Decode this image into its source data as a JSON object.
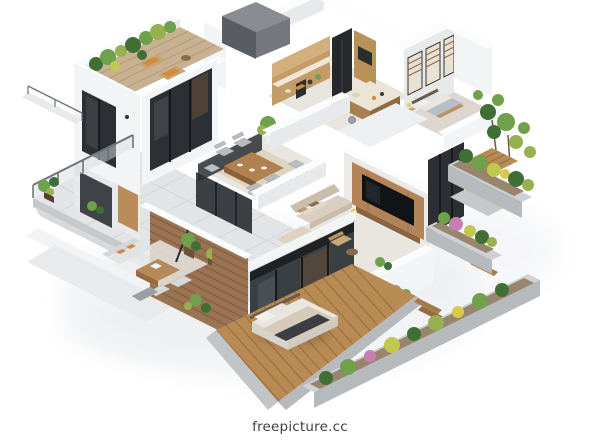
{
  "watermark": {
    "text": "freepicture.cc"
  },
  "palette": {
    "background": "#ffffff",
    "shadow": "#e9ebee",
    "wall_top": "#fbfcfd",
    "wall_face": "#f3f4f6",
    "wall_shade": "#e7e9eb",
    "wood": "#b98c5a",
    "wood_dark": "#8d6138",
    "deck": "#b88a54",
    "deck_line": "#9c7040",
    "slat_wall": "#9a7452",
    "glass": "#2c3034",
    "glass_light": "#3a3f44",
    "tv_black": "#111316",
    "green_dark": "#3f6f34",
    "green_mid": "#6fa04b",
    "green_light": "#97b050",
    "green_yellow": "#c2c84f",
    "flower_pink": "#c77fb0",
    "flower_yellow": "#d9c84e",
    "concrete": "#c6c9cb",
    "concrete_dark": "#b7babc",
    "paving": "#e3e4e5",
    "paving_line": "#d2d4d6",
    "floor": "#e9e5df",
    "rug": "#ddd2bf",
    "sofa": "#d9cec0",
    "bed_white": "#e9e6e0",
    "bed_gray": "#b8bec6",
    "duvet": "#d6cbb8",
    "throw_dark": "#3c3e44",
    "counter": "#efe6d6",
    "island_top": "#ece4d4",
    "accent_orange": "#d08c3e",
    "soil": "#97866d",
    "watermark_text": "#3f3f3f"
  }
}
